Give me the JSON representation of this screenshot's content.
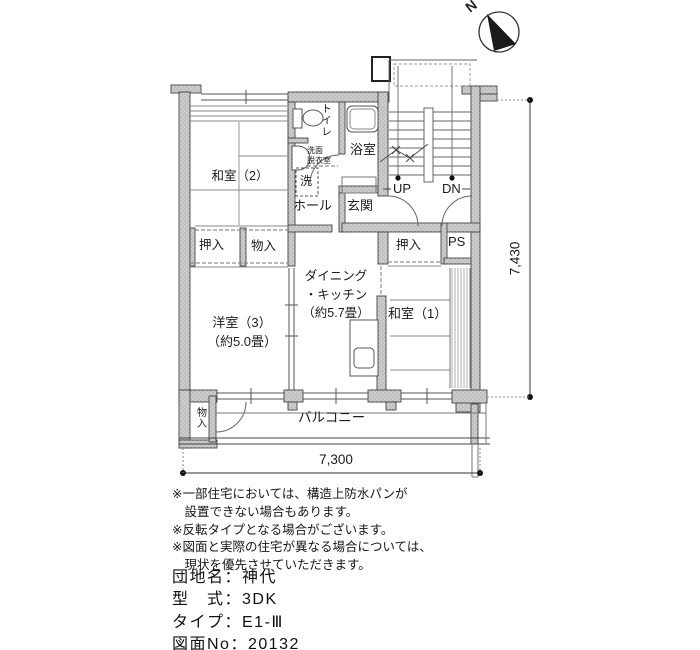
{
  "compass": {
    "label": "N"
  },
  "plan": {
    "rooms": {
      "washitsu2": "和室（2）",
      "toilet": "トイレ",
      "washroom": "洗面\n脱衣室",
      "laundry": "洗",
      "bath": "浴室",
      "hall": "ホール",
      "entrance": "玄関",
      "stairs_up": "UP",
      "stairs_down": "DN",
      "closet_left": "押入",
      "storage_top": "物入",
      "closet_right": "押入",
      "pipe_space": "PS",
      "dining_kitchen": "ダイニング\n・キッチン\n（約5.7畳）",
      "washitsu1": "和室（1）",
      "yoshitsu3": "洋室（3）\n（約5.0畳）",
      "storage_bottom": "物入",
      "balcony": "バルコニー"
    },
    "dimensions": {
      "width": "7,300",
      "height": "7,430"
    }
  },
  "notes": [
    "※一部住宅においては、構造上防水パンが",
    "　設置できない場合もあります。",
    "※反転タイプとなる場合がございます。",
    "※図面と実際の住宅が異なる場合については、",
    "　現状を優先させていただきます。"
  ],
  "info": [
    "団地名：神代",
    "型　式：3DK",
    "タイプ：E1-Ⅲ",
    "図面No：20132"
  ],
  "colors": {
    "wall": "#cccccc",
    "line": "#3c3c3c"
  }
}
